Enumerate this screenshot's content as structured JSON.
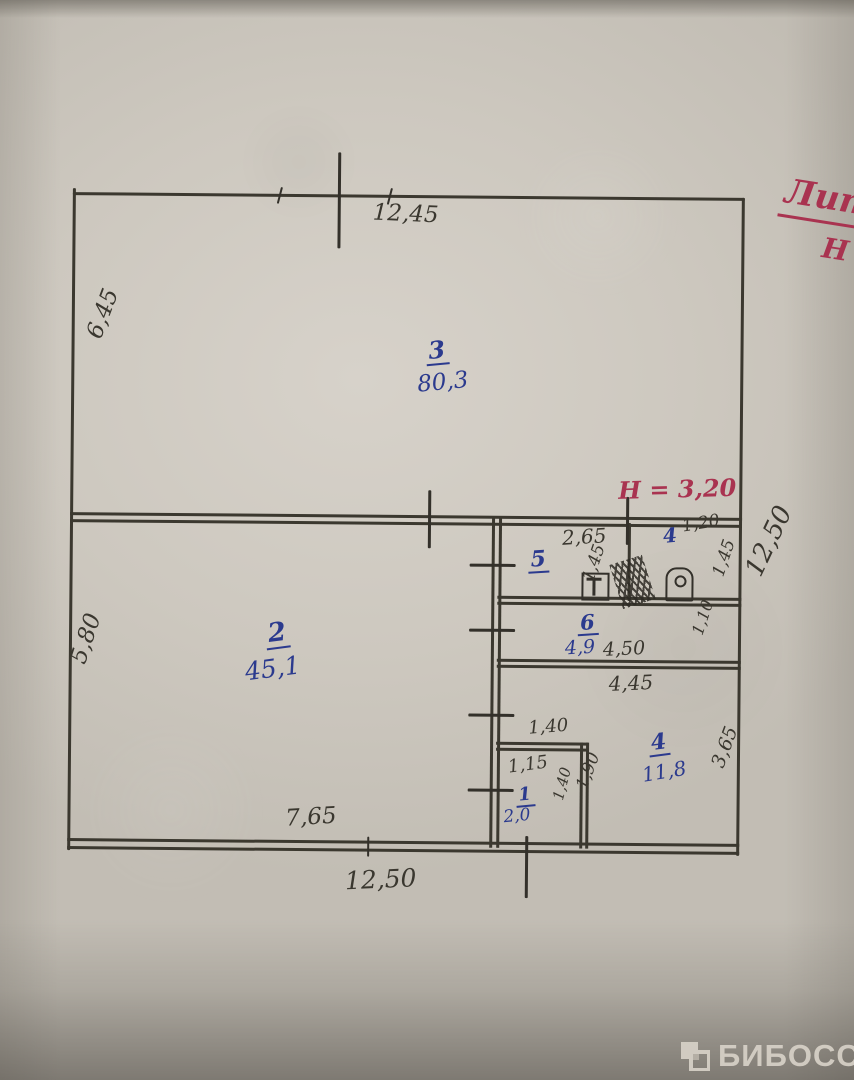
{
  "ink": {
    "pencil": "#3b382f",
    "blue": "#2b3a8e",
    "red": "#a93350",
    "watermark": "#d9d3c9"
  },
  "note_top_right": {
    "line1": "Лит",
    "line2": "Н"
  },
  "height_note": "Н = 3,20",
  "overall_dims": {
    "top": "12,45",
    "left_upper": "6,45",
    "left_lower": "5,80",
    "right": "12,50",
    "bottom_inner": "7,65",
    "bottom": "12,50"
  },
  "rooms": {
    "r3": {
      "number": "3",
      "area": "80,3"
    },
    "r2": {
      "number": "2",
      "area": "45,1"
    },
    "r5": {
      "number": "5",
      "width": "2,65",
      "depth": "1,45"
    },
    "r4wc": {
      "number": "4",
      "width": "1,20",
      "depth": "1,45"
    },
    "r6": {
      "number": "6",
      "area": "4,9",
      "width": "4,50",
      "depth": "1,10",
      "width_below": "4,45"
    },
    "r4": {
      "number": "4",
      "area": "11,8",
      "depth": "3,65"
    },
    "r1": {
      "number": "1",
      "area": "2,0",
      "width_outer": "1,40",
      "width_inner": "1,15",
      "depth_inner": "1,40",
      "depth_outer": "1,90"
    }
  },
  "watermark": {
    "label": "БИБОСС",
    "icon": "grid-logo-icon"
  }
}
